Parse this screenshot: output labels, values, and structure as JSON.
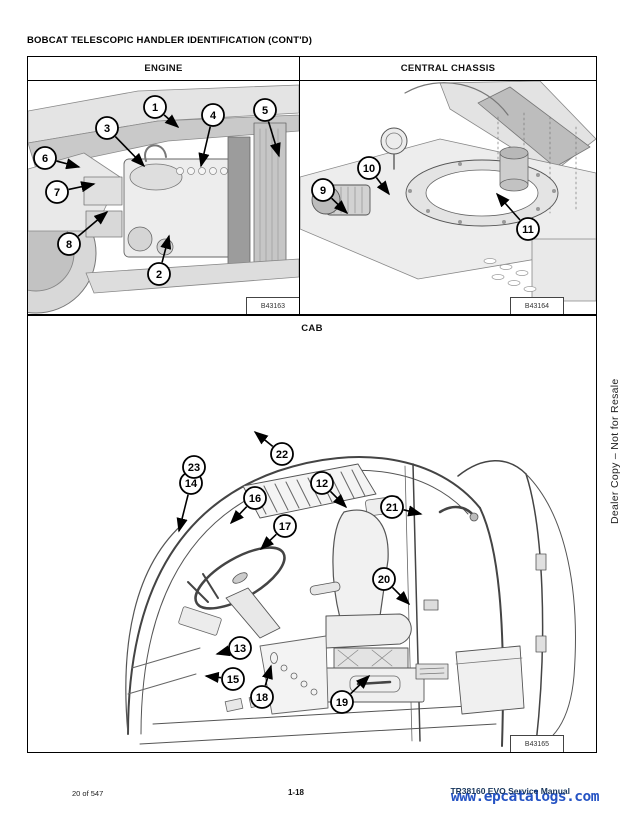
{
  "page": {
    "title": "BOBCAT TELESCOPIC HANDLER IDENTIFICATION (CONT'D)",
    "sidebar_watermark": "Dealer Copy – Not for Resale",
    "footer": {
      "page_count": "20 of 547",
      "page_number": "1-18",
      "manual_title": "TR38160 EVO Service Manual",
      "watermark": "www.epcatalogs.com"
    }
  },
  "colors": {
    "panel_border": "#000000",
    "manual_title_navy": "#17365d",
    "watermark_blue": "#2553c4",
    "callout_stroke": "#000000",
    "art_gray": "#d9d9d9"
  },
  "panels": [
    {
      "id": "engine",
      "label": "ENGINE",
      "figure_id": "B43163",
      "callouts": [
        {
          "n": "1",
          "x": 127,
          "y": 26,
          "ax": 150,
          "ay": 46
        },
        {
          "n": "2",
          "x": 131,
          "y": 193,
          "ax": 141,
          "ay": 155
        },
        {
          "n": "3",
          "x": 79,
          "y": 47,
          "ax": 116,
          "ay": 85
        },
        {
          "n": "4",
          "x": 185,
          "y": 34,
          "ax": 173,
          "ay": 85
        },
        {
          "n": "5",
          "x": 237,
          "y": 29,
          "ax": 251,
          "ay": 75
        },
        {
          "n": "6",
          "x": 17,
          "y": 77,
          "ax": 51,
          "ay": 86
        },
        {
          "n": "7",
          "x": 29,
          "y": 111,
          "ax": 66,
          "ay": 103
        },
        {
          "n": "8",
          "x": 41,
          "y": 163,
          "ax": 79,
          "ay": 131
        }
      ]
    },
    {
      "id": "chassis",
      "label": "CENTRAL CHASSIS",
      "figure_id": "B43164",
      "callouts": [
        {
          "n": "9",
          "x": 23,
          "y": 109,
          "ax": 47,
          "ay": 132
        },
        {
          "n": "10",
          "x": 69,
          "y": 87,
          "ax": 89,
          "ay": 113
        },
        {
          "n": "11",
          "x": 228,
          "y": 148,
          "ax": 197,
          "ay": 113
        }
      ]
    },
    {
      "id": "cab",
      "label": "CAB",
      "figure_id": "B43165",
      "callouts": [
        {
          "n": "12",
          "x": 294,
          "y": 167,
          "ax": 318,
          "ay": 191
        },
        {
          "n": "13",
          "x": 212,
          "y": 332,
          "ax": 189,
          "ay": 338
        },
        {
          "n": "14",
          "x": 163,
          "y": 167,
          "ax": 151,
          "ay": 215
        },
        {
          "n": "15",
          "x": 205,
          "y": 363,
          "ax": 178,
          "ay": 360
        },
        {
          "n": "16",
          "x": 227,
          "y": 182,
          "ax": 203,
          "ay": 207
        },
        {
          "n": "17",
          "x": 257,
          "y": 210,
          "ax": 233,
          "ay": 233
        },
        {
          "n": "18",
          "x": 234,
          "y": 381,
          "ax": 243,
          "ay": 350
        },
        {
          "n": "19",
          "x": 314,
          "y": 386,
          "ax": 341,
          "ay": 360
        },
        {
          "n": "20",
          "x": 356,
          "y": 263,
          "ax": 381,
          "ay": 288
        },
        {
          "n": "21",
          "x": 364,
          "y": 191,
          "ax": 393,
          "ay": 198
        },
        {
          "n": "22",
          "x": 254,
          "y": 138,
          "ax": 227,
          "ay": 116
        },
        {
          "n": "23",
          "x": 166,
          "y": 151,
          "ax": null,
          "ay": null
        }
      ]
    }
  ]
}
